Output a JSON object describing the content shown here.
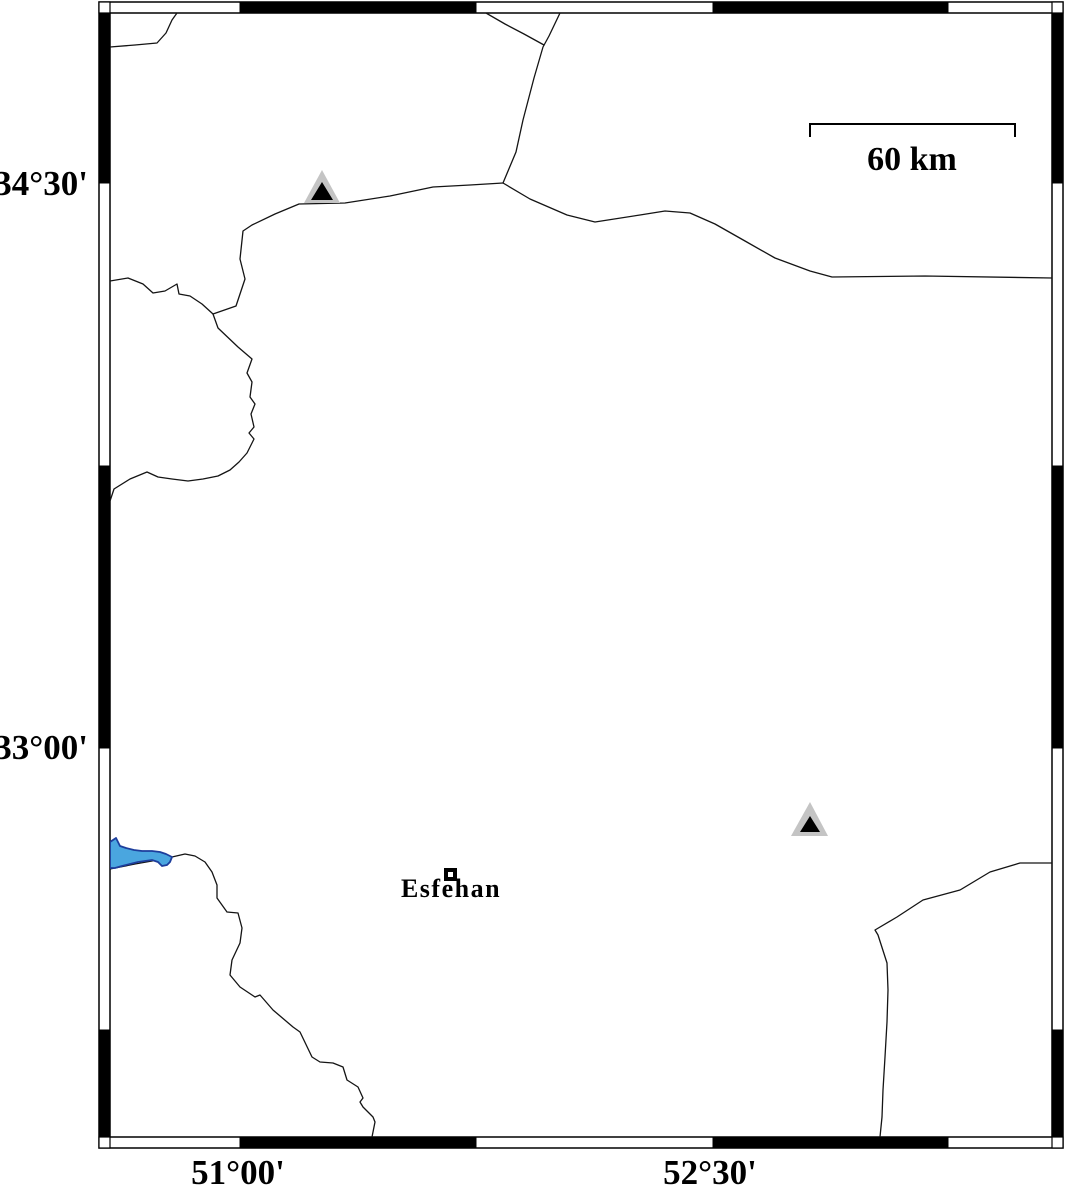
{
  "map": {
    "axis": {
      "left": [
        {
          "text": "34°30'",
          "y": 183
        },
        {
          "text": "33°00'",
          "y": 747
        }
      ],
      "bottom": [
        {
          "text": "51°00'",
          "x": 238
        },
        {
          "text": "52°30'",
          "x": 710
        }
      ]
    },
    "scale_bar": {
      "label": "60 km"
    },
    "city": {
      "name": "Esfehan"
    },
    "colors": {
      "line": "#141414",
      "lake_fill": "#4aa6df",
      "lake_outline": "#1d3e9c",
      "station_fill": "#c4c4c4",
      "station_inner": "#000000"
    },
    "features": {
      "roads": [
        "486,13 505,24 524,34 544,45",
        "560,13 549,36 543,47 534,78 523,120 516,152 503,183",
        "503,183 470,185 433,187 390,196 345,203 299,204 275,214 252,225 243,231 240,259 245,279 236,306 213,314 218,328 238,347 252,359 247,373 252,382 250,397 255,404 251,414 254,427 249,433 254,439 247,453 239,462 230,470 218,476 203,479 188,481 172,479 158,477 147,472 130,479 114,489 110,501",
        "110,281 128,278 143,284 153,293 165,291 177,284 179,294 190,296 202,304 213,314",
        "110,47 135,45 157,43 166,33 172,20 177,13",
        "503,183 530,199 567,215 595,222 640,215 665,211 690,213 715,224 745,241 775,258 810,271 832,277 925,276 1052,278",
        "110,869 135,864 152,861 166,858 172,857 185,854 195,856 205,862 212,872 217,885 217,898 227,912 238,913 242,928 240,943 232,960 230,975 240,987 255,997 260,995 273,1010 293,1027 300,1032 312,1057 320,1062 333,1063 343,1067 347,1080 358,1087 363,1098 360,1102 363,1107 373,1117 375,1122 373,1132 372,1137",
        "1052,863 1020,863 990,872 960,890 923,900 897,917 875,930 878,935 887,963 888,990 887,1022 885,1057 883,1090 882,1117 880,1137"
      ],
      "lake": "110,842 116,838 120,846 126,848 134,850 142,851 152,851 160,852 166,854 172,857 170,862 167,865 162,866 158,862 152,860 145,861 138,862 130,864 122,866 115,868 110,868",
      "stations": [
        {
          "outer": "322,170 340,203 304,203",
          "inner": "322,182 333,200 311,200"
        },
        {
          "outer": "810,802 828,836 791,836",
          "inner": "810,816 820,832 800,832"
        }
      ]
    }
  }
}
